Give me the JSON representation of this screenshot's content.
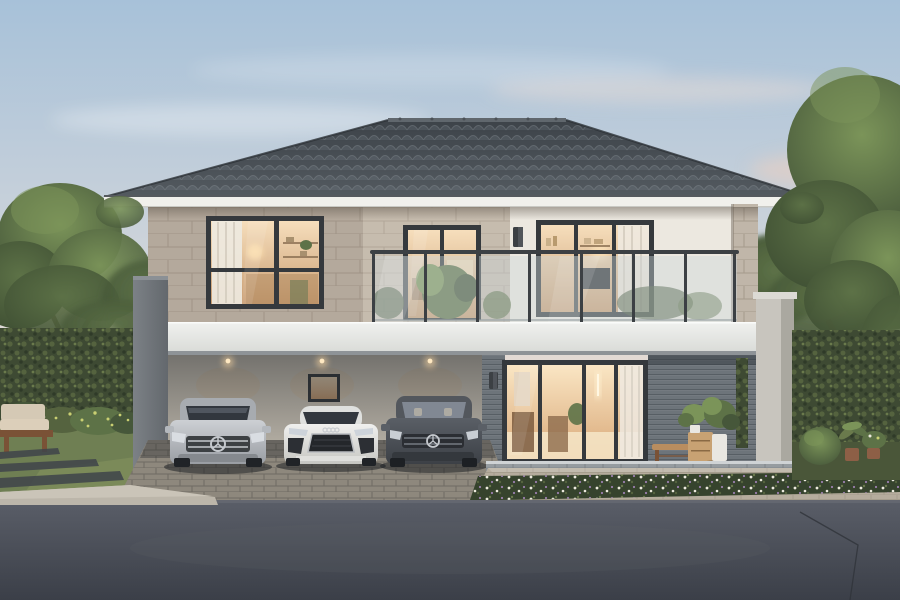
{
  "scene": {
    "description": "Dusk architectural rendering of a modern two-story house with a dark hipped tile roof, full-width glass-railed balcony, warm lit interiors, a carport sheltering three cars, a glass sliding door to the living room, and landscaped gardens with hedges and trees",
    "time_of_day": "dusk",
    "house": {
      "stories": "2",
      "roof": "hipped dark gray tile",
      "balcony": "glass railing with dark posts",
      "upper_windows": [
        "left bedroom window with curtain and shelves",
        "center balcony sliding door",
        "right bedroom window with TV and curtain"
      ],
      "ground_floor": [
        "open carport with downlights",
        "small lit window",
        "large sliding glass door to lit living room",
        "gray horizontal siding wall with bench and potted plants",
        "vertical garden strip"
      ]
    },
    "cars": [
      {
        "name": "silver-suv",
        "description": "silver luxury SUV with star grille badge"
      },
      {
        "name": "white-sports-car",
        "description": "white low sports car with wide dark grille"
      },
      {
        "name": "dark-gray-sedan",
        "description": "dark gray sedan with star grille badge"
      }
    ],
    "landscape": [
      "left hedge wall with large tree",
      "outdoor wooden bench with beige cushions",
      "flowering shrubs",
      "lawn with stepping stones",
      "white flower bed along the porch",
      "right hedge with topiary ball and potted plants",
      "large tree on the right",
      "paver driveway apron",
      "asphalt road foreground"
    ]
  },
  "colors": {
    "sky-top": "#a7c1d9",
    "sky-mid": "#ccd3da",
    "sky-low": "#e9dcd2",
    "sky-pink": "#f5d9c5",
    "cloud-pink": "#f2cfc0",
    "roof-dark": "#3d4349",
    "roof-bump": "#4a5158",
    "roof-highlight": "#5d646a",
    "fascia": "#f1f0ec",
    "gutter": "#55595e",
    "wall-greige": "#b4a99c",
    "wall-beige": "#c6bcae",
    "wall-cream": "#ece8e0",
    "joint-line": "#8d8275",
    "frame-dark": "#35393d",
    "curtain": "#eee9e0",
    "slab-white": "#f0f1ef",
    "slab-shadow": "#8e9397",
    "railing-glass": "#ccd6d9",
    "post-dark": "#3c4044",
    "pillar-light": "#7c8186",
    "pillar-dark": "#63686d",
    "siding-gray": "#6d747a",
    "siding-line": "#575e64",
    "carport-wall": "#ddd5c6",
    "light-warm": "#ffd9a0",
    "glass-warm-hi": "#f6debc",
    "glass-warm-lo": "#c99d72",
    "door-glass-hi": "#fae6c4",
    "door-glass-lo": "#d9a878",
    "glass-dark": "#32373e",
    "chrome": "#c4c8cd",
    "car-silver-hi": "#cdd0d4",
    "car-silver-lo": "#999da3",
    "car-white-hi": "#f0f0ee",
    "car-white-lo": "#c6c6c2",
    "car-dark-hi": "#5a5f66",
    "car-dark-lo": "#3c4046",
    "hedge-base": "#3e4a33",
    "hedge-leaf": "#55633f",
    "hedge-dark": "#2f3a28",
    "hedge-light": "#6a7a4c",
    "tree-dark": "#46573a",
    "tree-mid": "#5d7247",
    "tree-light": "#7b9459",
    "trunk": "#5d4a38",
    "grass": "#6f7f53",
    "grass-light": "#8a9a62",
    "bush-yellow": "#c9cf72",
    "flower-white": "#eceade",
    "flower-purple": "#9a7fae",
    "bed-green": "#36432d",
    "paver-floor": "#8e887d",
    "apron-tan": "#b5ac9d",
    "curb-light": "#bcb6aa",
    "blocks-gray": "#969ca0",
    "road-hi": "#5a5e68",
    "road-lo": "#3b3f48",
    "wood": "#b98d5f",
    "wood-dark": "#7a5236",
    "cushion": "#d5c9b5",
    "pot-white": "#e9e7e1",
    "pot-terra": "#8d5f46"
  }
}
